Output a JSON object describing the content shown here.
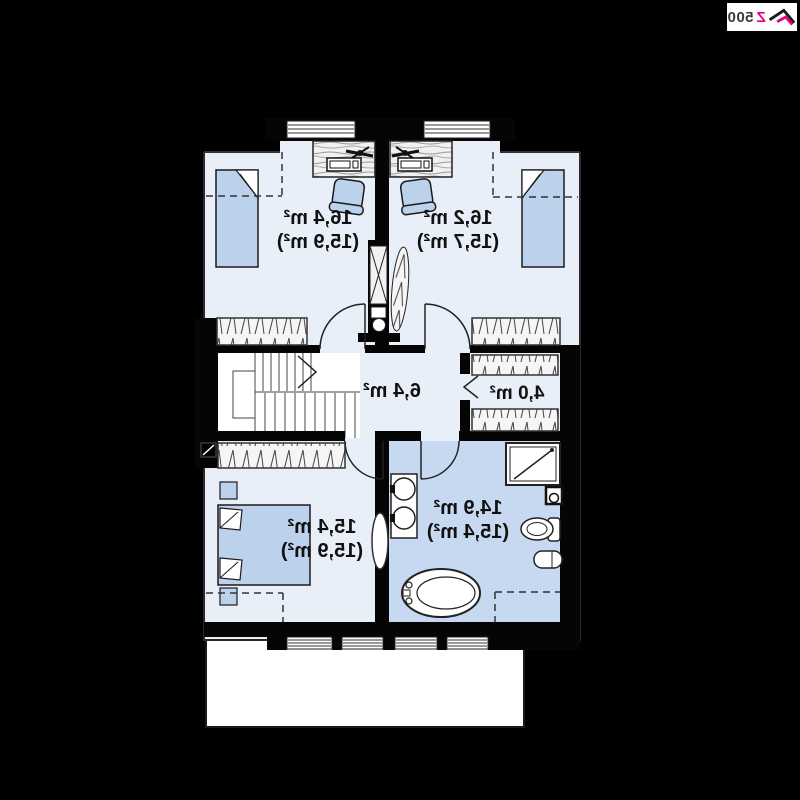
{
  "logo": {
    "brand_z": "Z",
    "brand_numbers": "500",
    "accent_color": "#e6007e",
    "text_color": "#3a3a3a"
  },
  "floor_plan": {
    "text_mirrored": true,
    "colors": {
      "background": "#000000",
      "walls": "#050505",
      "floor": "#e9eff9",
      "bathroom_floor": "#c6d9f1",
      "furniture_blue": "#bcd2ec",
      "stairs": "#ffffff",
      "balcony": "#ffffff"
    },
    "rooms": [
      {
        "id": "bedroom-top-left",
        "area": "16,4 m²",
        "area_secondary": "(15,9 m²)"
      },
      {
        "id": "bedroom-top-right",
        "area": "16,2 m²",
        "area_secondary": "(15,7 m²)"
      },
      {
        "id": "hall",
        "area": "6,4 m²",
        "area_secondary": ""
      },
      {
        "id": "closet",
        "area": "4,0 m²",
        "area_secondary": ""
      },
      {
        "id": "bedroom-bottom",
        "area": "15,4 m²",
        "area_secondary": "(15,9 m²)"
      },
      {
        "id": "bathroom",
        "area": "14,9 m²",
        "area_secondary": "(15,4 m²)"
      }
    ]
  }
}
